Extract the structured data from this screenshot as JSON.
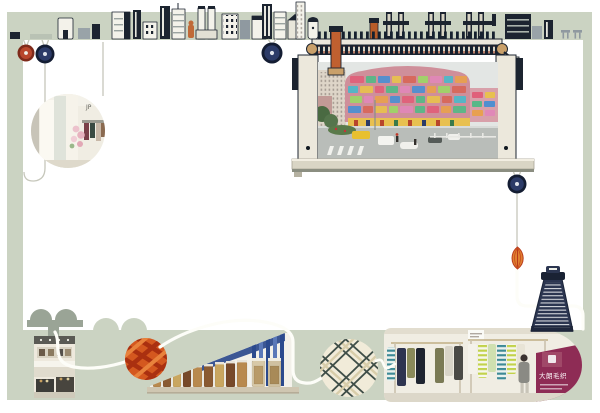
{
  "scene": {
    "texts": {
      "boutique_sign": "JP",
      "market_banner": "大朗毛织"
    }
  },
  "palette": {
    "frame_green": "#cbd3c2",
    "outline_navy": "#1c2430",
    "button_red": "#b8462c",
    "button_navy": "#2c3b68",
    "yarn_orange": "#d4581f",
    "yarn_cream": "#f1ebd9",
    "thread_cone_navy": "#2b3550",
    "bead_orange": "#e08030",
    "banner_purple": "#8e2c55",
    "thread_white": "#fdfdf8"
  },
  "elements": {
    "skyline": "city-skyline-illustration",
    "machine": "flat-knitting-machine-frame",
    "photos": [
      "boutique-interior-circle",
      "market-street-building",
      "shop-counter",
      "yarn-jar-shelves",
      "clothing-racks"
    ],
    "buttons": [
      "red-button",
      "navy-button",
      "navy-button",
      "navy-button"
    ],
    "yarn_balls": [
      "orange-yarn-ball",
      "cream-yarn-ball"
    ],
    "extras": [
      "thread-cone",
      "leaf-bead",
      "press-stand"
    ]
  }
}
